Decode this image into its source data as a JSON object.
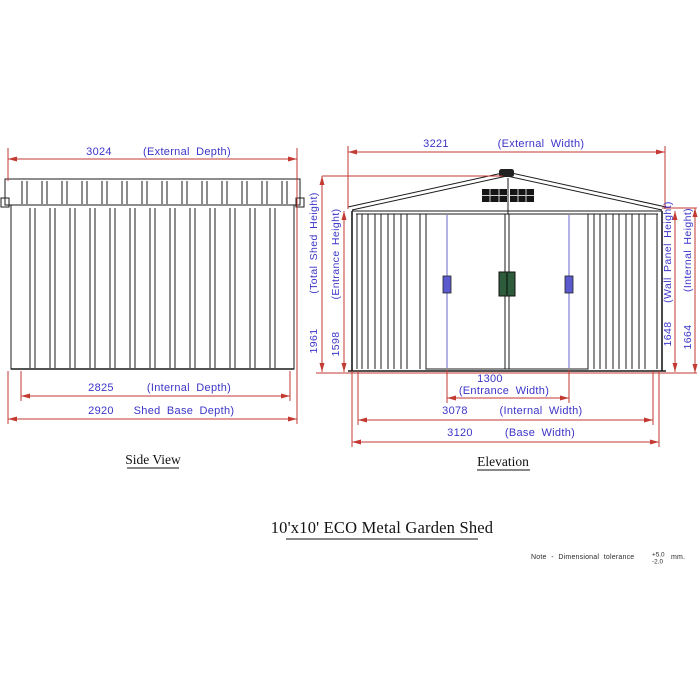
{
  "document": {
    "title": "10'x10' ECO Metal Garden Shed",
    "note": {
      "prefix": "Note  -  Dimensional  tolerance",
      "tol_plus": "+5.0",
      "tol_minus": "-2.0",
      "suffix": "mm."
    }
  },
  "side_view": {
    "label": "Side View",
    "dims": {
      "external_depth": {
        "value": "3024",
        "label": "(External Depth)"
      },
      "internal_depth": {
        "value": "2825",
        "label": "(Internal Depth)"
      },
      "base_depth": {
        "value": "2920",
        "label": "Shed Base Depth)"
      }
    }
  },
  "elevation": {
    "label": "Elevation",
    "dims": {
      "external_width": {
        "value": "3221",
        "label": "(External Width)"
      },
      "entrance_width": {
        "value": "1300",
        "label": "(Entrance Width)"
      },
      "internal_width": {
        "value": "3078",
        "label": "(Internal Width)"
      },
      "base_width": {
        "value": "3120",
        "label": "(Base Width)"
      },
      "total_shed_height": {
        "value": "1961",
        "label": "(Total Shed Height)"
      },
      "entrance_height": {
        "value": "1598",
        "label": "(Entrance Height)"
      },
      "wall_panel_height": {
        "value": "1648",
        "label": "(Wall Panel Height)"
      },
      "internal_height": {
        "value": "1664",
        "label": "(Internal Height)"
      }
    }
  },
  "colors": {
    "dimension_line": "#c23a32",
    "dimension_text": "#3c35c8",
    "drawing_line": "#1b1b1b",
    "door_guide": "#8080d8",
    "handle_blue": "#5a5ace",
    "handle_green": "#2f5b3d"
  }
}
